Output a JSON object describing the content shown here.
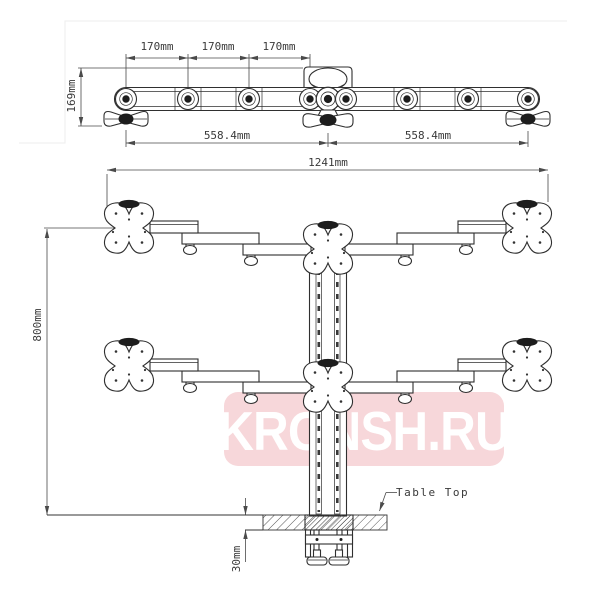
{
  "drawing": {
    "type": "monitor-desk-mount-technical-drawing",
    "top_view": {
      "dim_labels": {
        "arm_spacing_1": "170mm",
        "arm_spacing_2": "170mm",
        "arm_spacing_3": "170mm",
        "depth": "169mm",
        "half_span_left": "558.4mm",
        "half_span_right": "558.4mm"
      }
    },
    "front_view": {
      "dim_labels": {
        "total_width": "1241mm",
        "column_height": "800mm",
        "table_thickness": "30mm"
      },
      "annotations": {
        "table_top": "Table Top"
      }
    }
  },
  "watermark": {
    "text": "KRONSH.RU",
    "bg_color": "#f7d7da",
    "text_color": "#ffffff"
  },
  "colors": {
    "line": "#2f2f2f",
    "dim_line": "#4a4a4a",
    "text": "#3a3a3a"
  }
}
